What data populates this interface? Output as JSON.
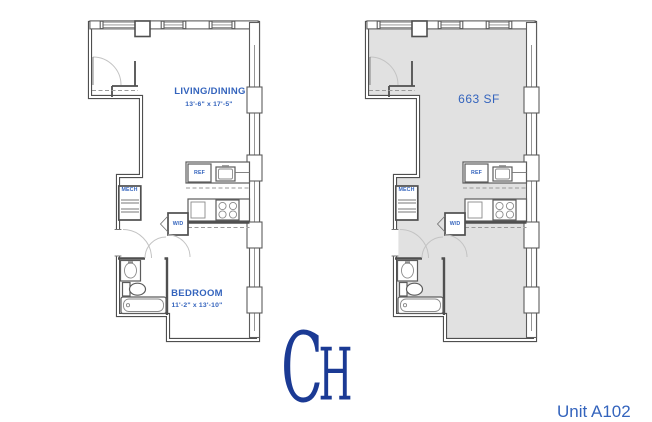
{
  "plans": {
    "left": {
      "rooms": [
        {
          "name": "LIVING/DINING",
          "dims": "13'-6\" x 17'-5\""
        },
        {
          "name": "BEDROOM",
          "dims": "11'-2\" x 13'-10\""
        }
      ],
      "fixtures": {
        "refrigerator": "REF",
        "washer_dryer": "W/D",
        "mechanical": "MECH"
      }
    },
    "right": {
      "area": "663 SF",
      "fixtures": {
        "refrigerator": "REF",
        "washer_dryer": "W/D",
        "mechanical": "MECH"
      }
    }
  },
  "logo": {
    "letter_c": "C",
    "letter_h": "H"
  },
  "footer": {
    "unit": "Unit A102"
  },
  "colors": {
    "wall": "#4f4f4f",
    "room_shade": "#e1e1e1",
    "label_blue": "#3464bd",
    "logo_blue": "#1b3a94"
  }
}
